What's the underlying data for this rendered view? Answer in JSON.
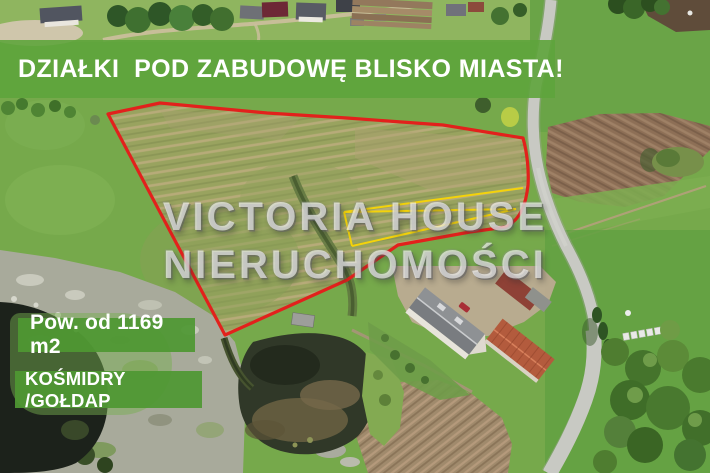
{
  "banner": {
    "headline": "DZIAŁKI  POD ZABUDOWĘ BLISKO MIASTA!"
  },
  "watermark": {
    "line1": "VICTORIA HOUSE",
    "line2": "NIERUCHOMOŚCI"
  },
  "badges": {
    "area": "Pow. od 1169 m2",
    "location": "KOŚMIDRY /GOŁDAP"
  },
  "colors": {
    "banner_green": "#5ea43c",
    "badge_green": "#4f9833",
    "plot_outline_red": "#e2211c",
    "subdivision_yellow": "#f4d30a",
    "watermark_white": "rgba(255,255,255,0.60)"
  }
}
